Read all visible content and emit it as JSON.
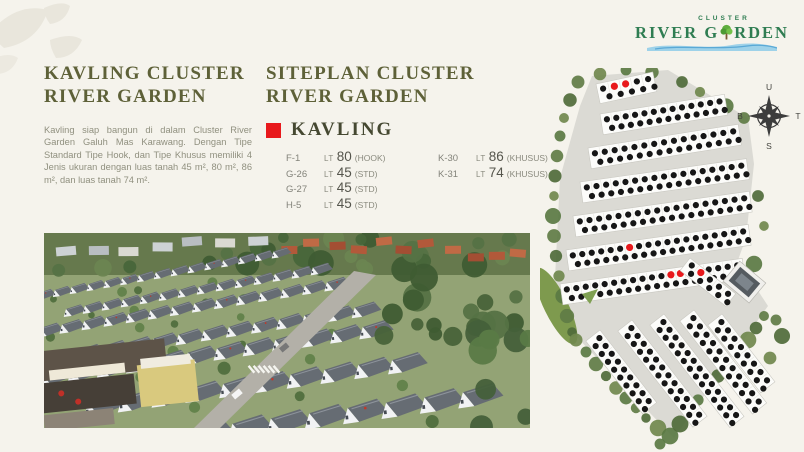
{
  "colors": {
    "background": "#f5f3ec",
    "heading": "#5e6138",
    "highlight_red": "#e8191c",
    "logo_green": "#2f7d52",
    "wave_blue": "#8ecbe9"
  },
  "left_panel": {
    "title_line1": "KAVLING CLUSTER",
    "title_line2": "RIVER GARDEN",
    "description": "Kavling siap bangun di dalam Cluster River Garden Galuh Mas Karawang. Dengan Tipe Standard Tipe Hook, dan Tipe Khusus memiliki 4 Jenis ukuran dengan luas tanah 45 m², 80 m², 86 m², dan luas tanah 74 m²."
  },
  "siteplan_panel": {
    "title_line1": "SITEPLAN CLUSTER",
    "title_line2": "RIVER GARDEN",
    "legend_label": "KAVLING",
    "lt_label": "LT",
    "lots": [
      {
        "code": "F-1",
        "area": "80",
        "type": "(HOOK)"
      },
      {
        "code": "G-26",
        "area": "45",
        "type": "(STD)"
      },
      {
        "code": "G-27",
        "area": "45",
        "type": "(STD)"
      },
      {
        "code": "H-5",
        "area": "45",
        "type": "(STD)"
      },
      {
        "code": "K-30",
        "area": "86",
        "type": "(KHUSUS)"
      },
      {
        "code": "K-31",
        "area": "74",
        "type": "(KHUSUS)"
      }
    ]
  },
  "logo": {
    "cluster": "CLUSTER",
    "name_pre": "RIVER G",
    "name_post": "RDEN"
  },
  "compass": {
    "north": "U",
    "east": "T",
    "south": "S",
    "west": "B"
  },
  "siteplan_map": {
    "land_color": "#dbdad4",
    "strip_color": "#fcfcfa",
    "dot_color": "#161616",
    "highlight_color": "#e8191c",
    "rows": [
      {
        "x": 56,
        "y": 16,
        "len": 58,
        "h": 20,
        "angle": -12,
        "dots": 5,
        "red": [
          1,
          2
        ]
      },
      {
        "x": 60,
        "y": 46,
        "len": 126,
        "h": 21,
        "angle": -9,
        "dots": 13,
        "red": []
      },
      {
        "x": 48,
        "y": 80,
        "len": 152,
        "h": 21,
        "angle": -9,
        "dots": 15,
        "red": []
      },
      {
        "x": 40,
        "y": 114,
        "len": 168,
        "h": 21,
        "angle": -8,
        "dots": 17,
        "red": []
      },
      {
        "x": 33,
        "y": 148,
        "len": 178,
        "h": 21,
        "angle": -8,
        "dots": 18,
        "red": []
      },
      {
        "x": 26,
        "y": 182,
        "len": 184,
        "h": 21,
        "angle": -8,
        "dots": 19,
        "red": [
          6
        ]
      },
      {
        "x": 20,
        "y": 216,
        "len": 184,
        "h": 21,
        "angle": -8,
        "dots": 19,
        "red": [
          11,
          12
        ]
      }
    ],
    "diagonals": [
      {
        "x": 150,
        "y": 190,
        "len": 58,
        "h": 16,
        "angle": 38,
        "dots": 5,
        "red": [
          1
        ]
      },
      {
        "x": 60,
        "y": 262,
        "len": 92,
        "h": 18,
        "angle": 52,
        "dots": 9,
        "red": []
      },
      {
        "x": 92,
        "y": 252,
        "len": 122,
        "h": 18,
        "angle": 52,
        "dots": 12,
        "red": []
      },
      {
        "x": 124,
        "y": 246,
        "len": 130,
        "h": 18,
        "angle": 52,
        "dots": 13,
        "red": []
      },
      {
        "x": 154,
        "y": 242,
        "len": 118,
        "h": 18,
        "angle": 52,
        "dots": 11,
        "red": []
      },
      {
        "x": 182,
        "y": 246,
        "len": 86,
        "h": 18,
        "angle": 52,
        "dots": 8,
        "red": []
      }
    ]
  }
}
